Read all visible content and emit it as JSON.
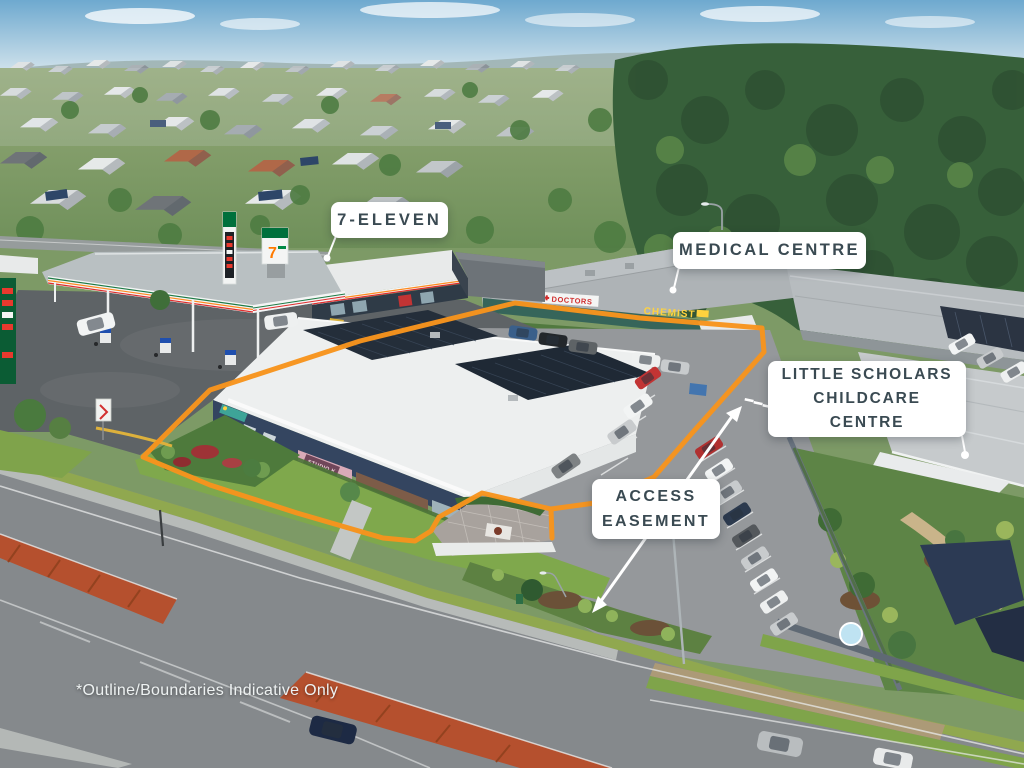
{
  "callouts": {
    "seven_eleven": {
      "label": "7-ELEVEN"
    },
    "medical_centre": {
      "label": "MEDICAL CENTRE"
    },
    "childcare": {
      "lines": [
        "LITTLE SCHOLARS",
        "CHILDCARE",
        "CENTRE"
      ]
    },
    "access_easement": {
      "lines": [
        "ACCESS",
        "EASEMENT"
      ]
    }
  },
  "disclaimer": "*Outline/Boundaries Indicative Only",
  "signage": {
    "doctors": "DOCTORS",
    "chemist": "CHEMIST",
    "studio": "STUDIO K"
  },
  "colors": {
    "boundary_orange": "#F7941D",
    "callout_bg": "#FFFFFF",
    "callout_text": "#3A4A52",
    "arrow_white": "#FFFFFF"
  }
}
